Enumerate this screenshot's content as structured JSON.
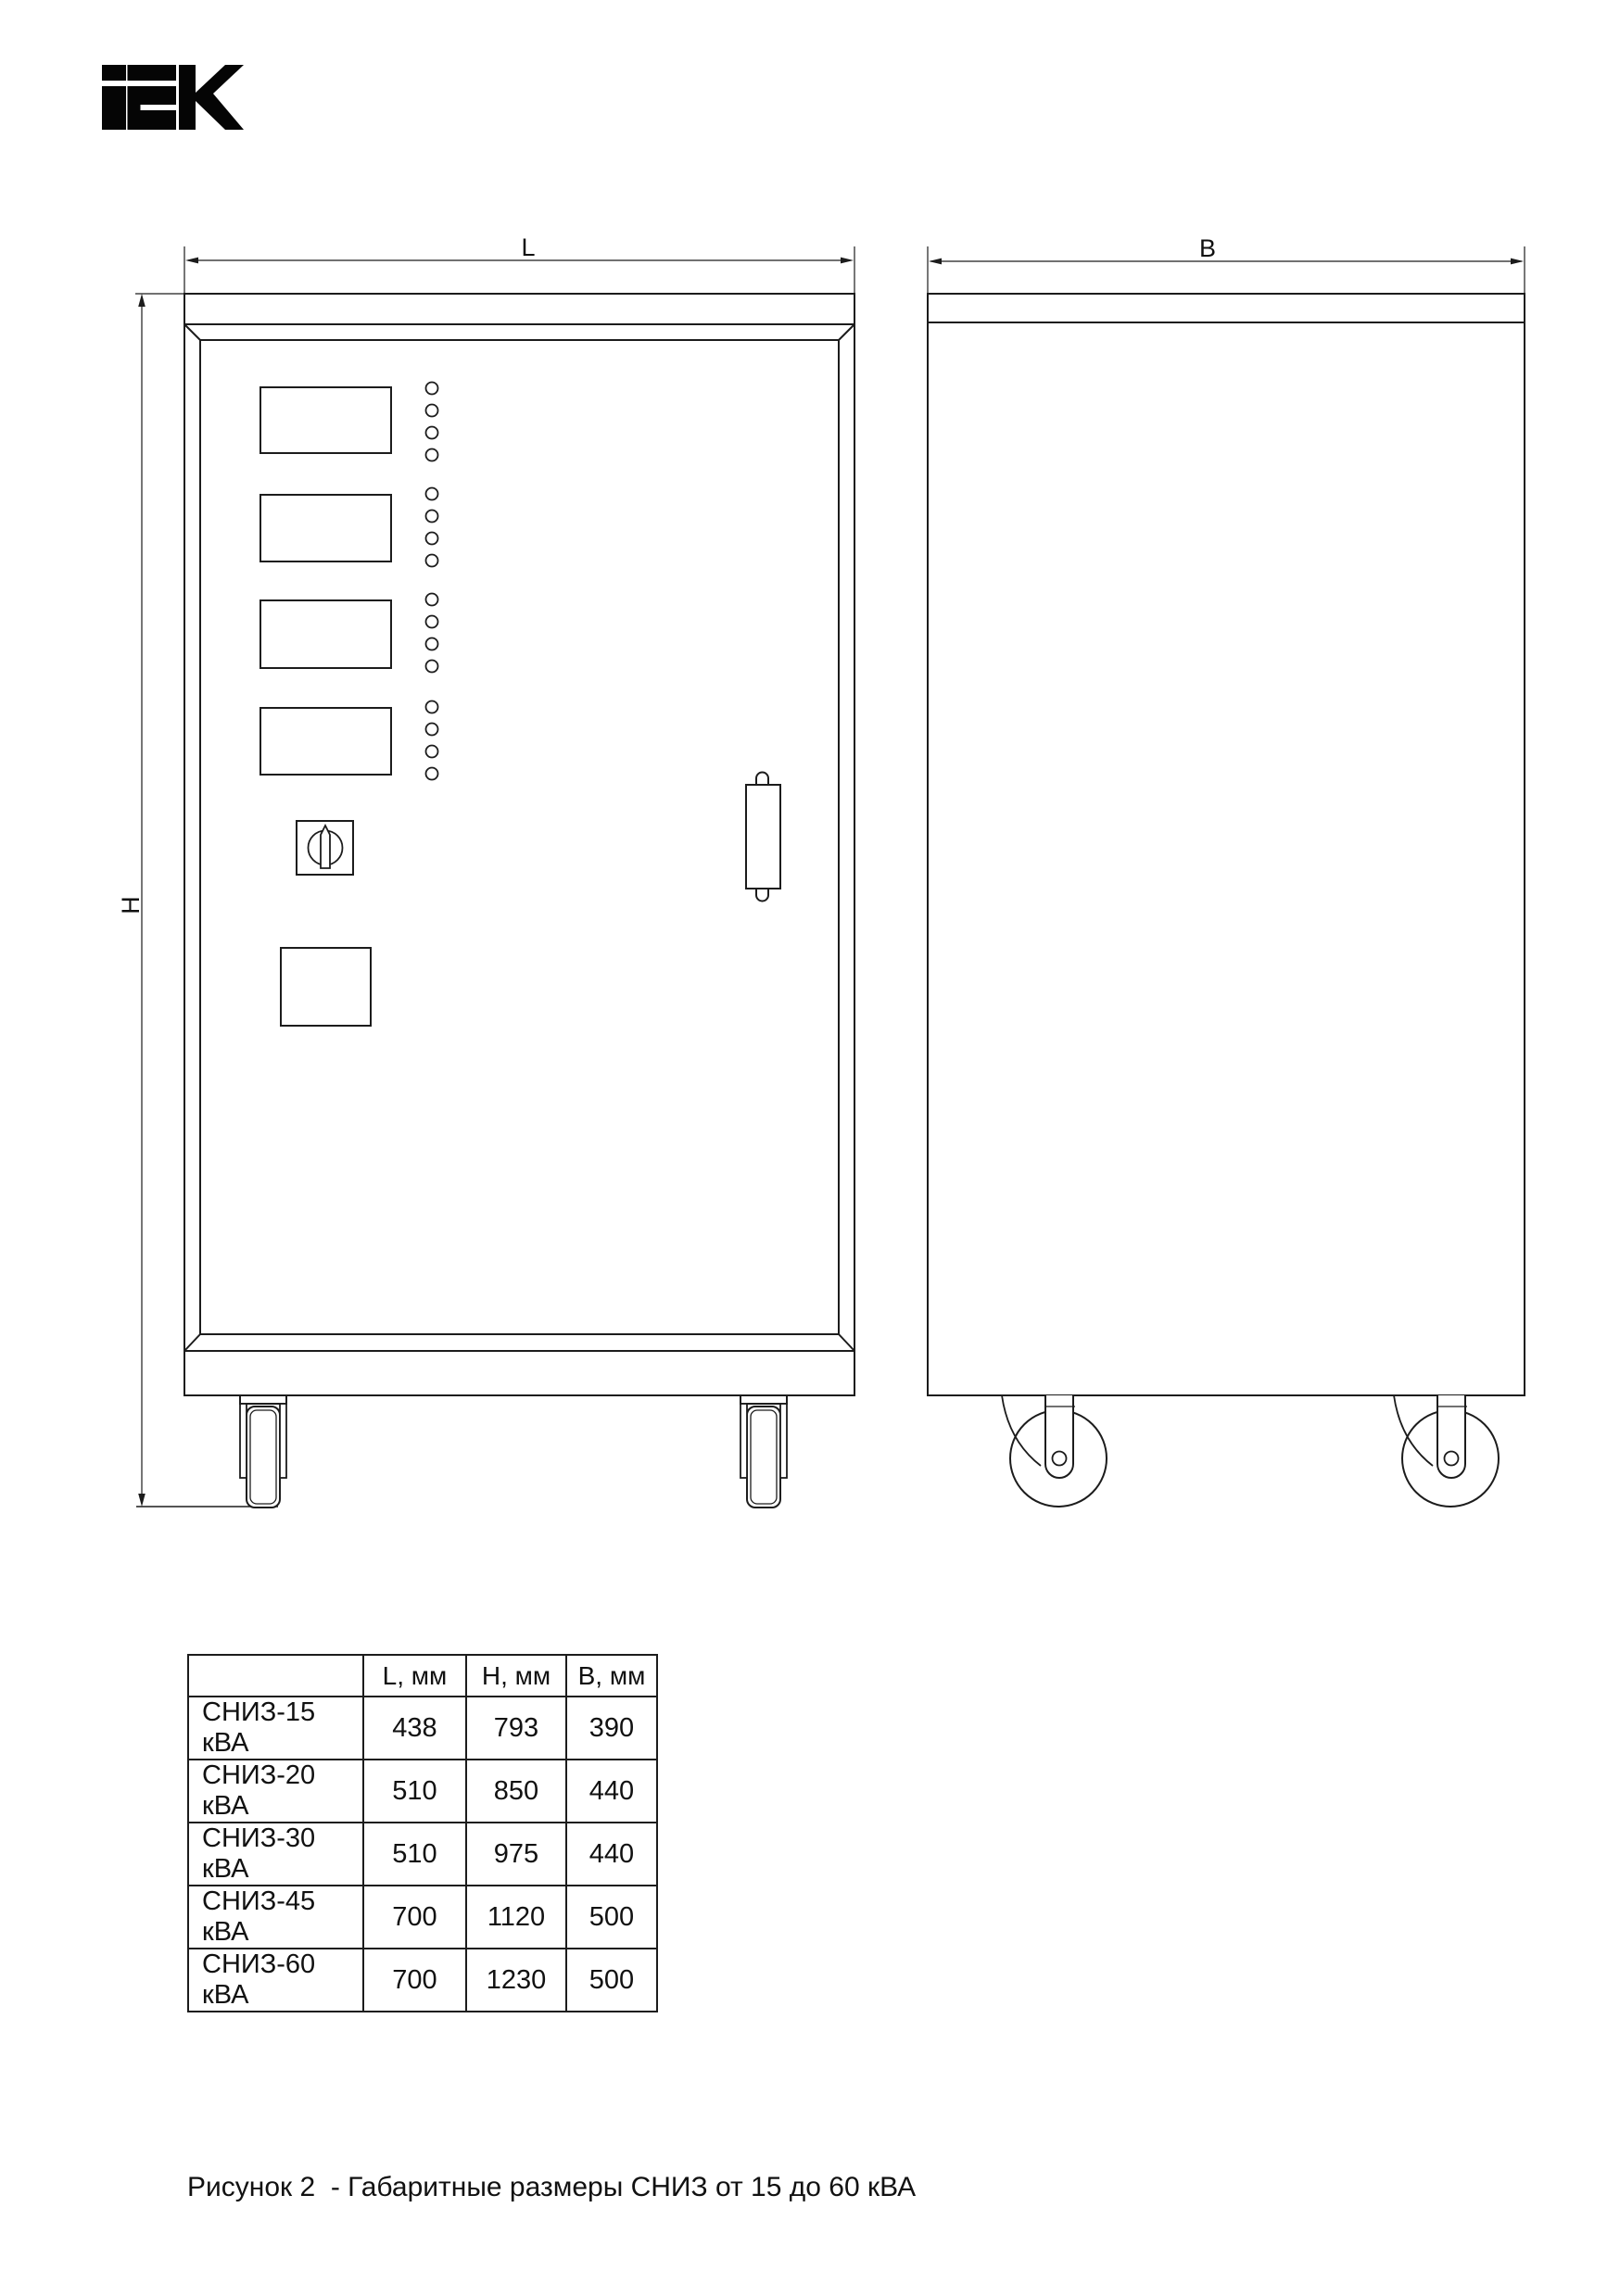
{
  "logo": {
    "name": "IEK"
  },
  "drawing": {
    "front_view": {
      "dim_width_label": "L",
      "dim_height_label": "H"
    },
    "side_view": {
      "dim_width_label": "B"
    }
  },
  "table": {
    "headers": [
      "",
      "L, мм",
      "H, мм",
      "B, мм"
    ],
    "rows": [
      {
        "model": "СНИЗ-15 кВА",
        "l": "438",
        "h": "793",
        "b": "390"
      },
      {
        "model": "СНИЗ-20 кВА",
        "l": "510",
        "h": "850",
        "b": "440"
      },
      {
        "model": "СНИЗ-30 кВА",
        "l": "510",
        "h": "975",
        "b": "440"
      },
      {
        "model": "СНИЗ-45 кВА",
        "l": "700",
        "h": "1120",
        "b": "500"
      },
      {
        "model": "СНИЗ-60 кВА",
        "l": "700",
        "h": "1230",
        "b": "500"
      }
    ]
  },
  "caption": "Рисунок 2  - Габаритные размеры СНИЗ от 15 до 60 кВА",
  "colors": {
    "line": "#1c1c1c",
    "background": "#ffffff"
  }
}
